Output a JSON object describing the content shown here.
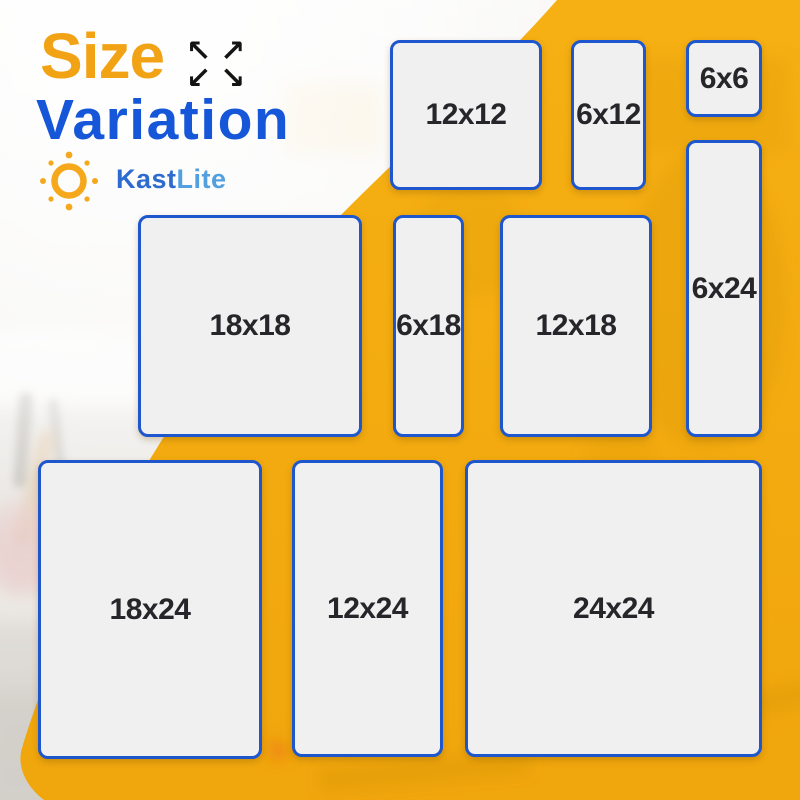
{
  "header": {
    "title_line1": "Size",
    "title_line2": "Variation",
    "expand_icon_glyphs": {
      "nw": "↖",
      "ne": "↗",
      "sw": "↙",
      "se": "↘"
    }
  },
  "brand": {
    "name": "KastLite",
    "name_part1": "Kast",
    "name_part2": "Lite"
  },
  "panels": [
    {
      "id": "12x12",
      "label": "12x12",
      "width_in": 12,
      "height_in": 12
    },
    {
      "id": "6x12",
      "label": "6x12",
      "width_in": 6,
      "height_in": 12
    },
    {
      "id": "6x6",
      "label": "6x6",
      "width_in": 6,
      "height_in": 6
    },
    {
      "id": "6x24",
      "label": "6x24",
      "width_in": 6,
      "height_in": 24
    },
    {
      "id": "18x18",
      "label": "18x18",
      "width_in": 18,
      "height_in": 18
    },
    {
      "id": "6x18",
      "label": "6x18",
      "width_in": 6,
      "height_in": 18
    },
    {
      "id": "12x18",
      "label": "12x18",
      "width_in": 12,
      "height_in": 18
    },
    {
      "id": "18x24",
      "label": "18x24",
      "width_in": 18,
      "height_in": 24
    },
    {
      "id": "12x24",
      "label": "12x24",
      "width_in": 12,
      "height_in": 24
    },
    {
      "id": "24x24",
      "label": "24x24",
      "width_in": 24,
      "height_in": 24
    }
  ],
  "colors": {
    "accent_yellow": "#F3A90F",
    "title_orange": "#F2A315",
    "title_blue": "#1557D8",
    "panel_border_blue": "#1E56CE",
    "panel_fill": "#F0F0F0",
    "panel_text": "#26262A",
    "brand_blue_dark": "#2E6BD0",
    "brand_blue_light": "#52A0E0",
    "logo_orange": "#F5A81C"
  }
}
